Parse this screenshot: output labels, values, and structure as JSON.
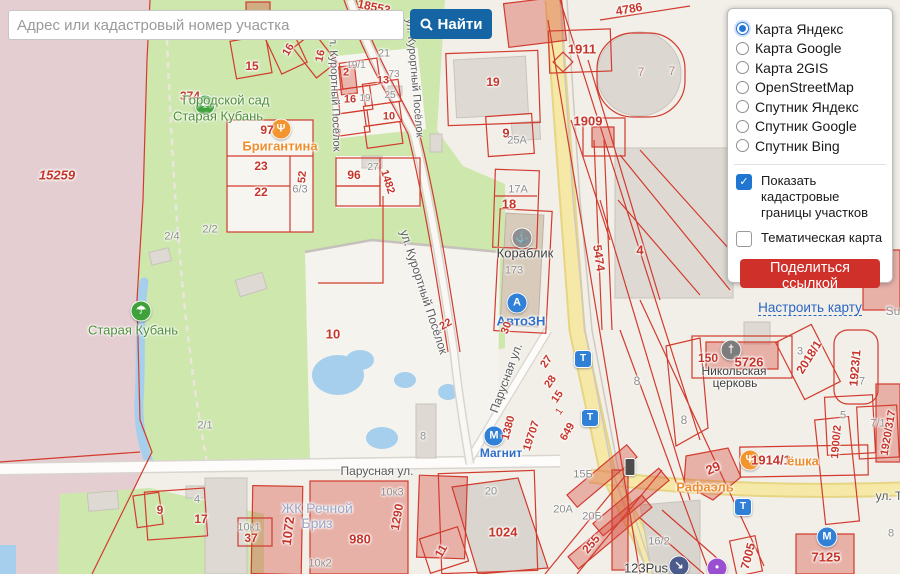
{
  "search": {
    "placeholder": "Адрес или кадастровый номер участка",
    "button_label": "Найти"
  },
  "panel": {
    "basemaps": [
      {
        "label": "Карта Яндекс",
        "selected": true
      },
      {
        "label": "Карта Google",
        "selected": false
      },
      {
        "label": "Карта 2GIS",
        "selected": false
      },
      {
        "label": "OpenStreetMap",
        "selected": false
      },
      {
        "label": "Спутник Яндекс",
        "selected": false
      },
      {
        "label": "Спутник Google",
        "selected": false
      },
      {
        "label": "Спутник Bing",
        "selected": false
      }
    ],
    "options": [
      {
        "label": "Показать кадастровые границы участков",
        "checked": true
      },
      {
        "label": "Тематическая карта",
        "checked": false
      }
    ],
    "share_button": "Поделиться ссылкой",
    "settings_link": "Настроить карту"
  },
  "map": {
    "palette": {
      "red": "#c6352a",
      "gray": "#8e8e8e",
      "dark": "#3f3f3f",
      "green": "#4f8f3a",
      "orange": "#ef8e2e",
      "blue": "#2f6fc8",
      "zk": "#98a6c6",
      "street": "#5a5a5a",
      "brick": "#b5867b"
    },
    "labels": [
      {
        "t": "18553",
        "x": 374,
        "y": 7,
        "c": "red",
        "s": 12,
        "r": 12,
        "b": 1
      },
      {
        "t": "16",
        "x": 289,
        "y": 50,
        "c": "red",
        "s": 11,
        "r": -60,
        "b": 1
      },
      {
        "t": "16",
        "x": 321,
        "y": 56,
        "c": "red",
        "s": 11,
        "r": -78,
        "b": 1
      },
      {
        "t": "15",
        "x": 252,
        "y": 66,
        "c": "red",
        "s": 12,
        "b": 1
      },
      {
        "t": "21",
        "x": 384,
        "y": 54,
        "c": "gray",
        "s": 11
      },
      {
        "t": "19/1",
        "x": 356,
        "y": 66,
        "c": "gray",
        "s": 10
      },
      {
        "t": "2",
        "x": 346,
        "y": 73,
        "c": "red",
        "s": 11,
        "b": 1
      },
      {
        "t": "13",
        "x": 383,
        "y": 81,
        "c": "red",
        "s": 11,
        "b": 1
      },
      {
        "t": "73",
        "x": 394,
        "y": 75,
        "c": "gray",
        "s": 10
      },
      {
        "t": "16",
        "x": 350,
        "y": 100,
        "c": "red",
        "s": 11,
        "b": 1
      },
      {
        "t": "19",
        "x": 365,
        "y": 99,
        "c": "gray",
        "s": 10
      },
      {
        "t": "25",
        "x": 390,
        "y": 96,
        "c": "gray",
        "s": 10
      },
      {
        "t": "10",
        "x": 389,
        "y": 117,
        "c": "red",
        "s": 11,
        "b": 1
      },
      {
        "t": "19",
        "x": 493,
        "y": 82,
        "c": "red",
        "s": 12,
        "b": 1
      },
      {
        "t": "374",
        "x": 190,
        "y": 96,
        "c": "red",
        "s": 12,
        "b": 1
      },
      {
        "t": "Городской сад",
        "x": 226,
        "y": 100,
        "c": "green",
        "s": 13
      },
      {
        "t": "Старая Кубань",
        "x": 218,
        "y": 116,
        "c": "green",
        "s": 13
      },
      {
        "t": "97",
        "x": 267,
        "y": 130,
        "c": "red",
        "s": 12,
        "b": 1
      },
      {
        "t": "Бригантина",
        "x": 280,
        "y": 146,
        "c": "orange",
        "s": 13,
        "b": 1
      },
      {
        "t": "23",
        "x": 261,
        "y": 166,
        "c": "red",
        "s": 12,
        "b": 1
      },
      {
        "t": "22",
        "x": 261,
        "y": 192,
        "c": "red",
        "s": 12,
        "b": 1
      },
      {
        "t": "52",
        "x": 303,
        "y": 177,
        "c": "red",
        "s": 11,
        "r": -85,
        "b": 1
      },
      {
        "t": "6/3",
        "x": 300,
        "y": 190,
        "c": "gray",
        "s": 11
      },
      {
        "t": "96",
        "x": 354,
        "y": 175,
        "c": "red",
        "s": 12,
        "b": 1
      },
      {
        "t": "27",
        "x": 373,
        "y": 168,
        "c": "gray",
        "s": 10
      },
      {
        "t": "1482",
        "x": 387,
        "y": 182,
        "c": "red",
        "s": 11,
        "r": 72,
        "b": 1
      },
      {
        "t": "15259",
        "x": 57,
        "y": 175,
        "c": "red",
        "s": 13,
        "i": 1,
        "b": 1
      },
      {
        "t": "2/4",
        "x": 172,
        "y": 237,
        "c": "gray",
        "s": 11
      },
      {
        "t": "2/2",
        "x": 210,
        "y": 230,
        "c": "gray",
        "s": 11
      },
      {
        "t": "10",
        "x": 333,
        "y": 334,
        "c": "red",
        "s": 13,
        "b": 1
      },
      {
        "t": "22",
        "x": 446,
        "y": 325,
        "c": "red",
        "s": 11,
        "r": -30,
        "b": 1
      },
      {
        "t": "2/1",
        "x": 205,
        "y": 426,
        "c": "gray",
        "s": 11
      },
      {
        "t": "Старая Кубань",
        "x": 133,
        "y": 330,
        "c": "green",
        "s": 13
      },
      {
        "t": "ул. Курортный Посёлок",
        "x": 414,
        "y": 78,
        "c": "street",
        "s": 11,
        "r": 85
      },
      {
        "t": "ул. Курортный Посёлок",
        "x": 334,
        "y": 92,
        "c": "street",
        "s": 11,
        "r": 88
      },
      {
        "t": "ул. Курортный Посёлок",
        "x": 424,
        "y": 292,
        "c": "street",
        "s": 12,
        "r": 72
      },
      {
        "t": "Парусная ул.",
        "x": 377,
        "y": 471,
        "c": "street",
        "s": 12
      },
      {
        "t": "Парусная ул.",
        "x": 506,
        "y": 378,
        "c": "street",
        "s": 12,
        "r": -70
      },
      {
        "t": "ул. Т",
        "x": 889,
        "y": 496,
        "c": "street",
        "s": 12
      },
      {
        "t": "9",
        "x": 506,
        "y": 133,
        "c": "red",
        "s": 13,
        "b": 1
      },
      {
        "t": "25А",
        "x": 517,
        "y": 141,
        "c": "gray",
        "s": 11
      },
      {
        "t": "1909",
        "x": 588,
        "y": 121,
        "c": "red",
        "s": 13,
        "b": 1
      },
      {
        "t": "1911",
        "x": 582,
        "y": 49,
        "c": "red",
        "s": 13,
        "b": 1
      },
      {
        "t": "4786",
        "x": 629,
        "y": 9,
        "c": "red",
        "s": 12,
        "r": -10,
        "b": 1
      },
      {
        "t": "7",
        "x": 641,
        "y": 72,
        "c": "brick",
        "s": 12
      },
      {
        "t": "7",
        "x": 672,
        "y": 71,
        "c": "brick",
        "s": 12
      },
      {
        "t": "17А",
        "x": 518,
        "y": 190,
        "c": "gray",
        "s": 11
      },
      {
        "t": "18",
        "x": 509,
        "y": 204,
        "c": "red",
        "s": 13,
        "b": 1
      },
      {
        "t": "Кораблик",
        "x": 525,
        "y": 253,
        "c": "dark",
        "s": 13
      },
      {
        "t": "173",
        "x": 514,
        "y": 271,
        "c": "gray",
        "s": 11
      },
      {
        "t": "АвтоЗН",
        "x": 521,
        "y": 321,
        "c": "blue",
        "s": 13,
        "b": 1
      },
      {
        "t": "30",
        "x": 507,
        "y": 328,
        "c": "red",
        "s": 11,
        "r": -70,
        "b": 1
      },
      {
        "t": "5474",
        "x": 599,
        "y": 258,
        "c": "red",
        "s": 12,
        "r": 82,
        "b": 1
      },
      {
        "t": "4",
        "x": 640,
        "y": 250,
        "c": "red",
        "s": 13,
        "b": 1
      },
      {
        "t": "27",
        "x": 547,
        "y": 362,
        "c": "red",
        "s": 11,
        "r": -55,
        "b": 1
      },
      {
        "t": "28",
        "x": 551,
        "y": 382,
        "c": "red",
        "s": 11,
        "r": -55,
        "b": 1
      },
      {
        "t": "15",
        "x": 558,
        "y": 397,
        "c": "red",
        "s": 11,
        "r": -55,
        "b": 1
      },
      {
        "t": "1",
        "x": 560,
        "y": 412,
        "c": "red",
        "s": 10,
        "r": -55
      },
      {
        "t": "1380",
        "x": 509,
        "y": 428,
        "c": "red",
        "s": 11,
        "r": -75,
        "b": 1
      },
      {
        "t": "19707",
        "x": 532,
        "y": 436,
        "c": "red",
        "s": 11,
        "r": -72,
        "b": 1
      },
      {
        "t": "649",
        "x": 568,
        "y": 432,
        "c": "red",
        "s": 11,
        "r": -60,
        "b": 1
      },
      {
        "t": "Магнит",
        "x": 501,
        "y": 453,
        "c": "blue",
        "s": 12,
        "b": 1
      },
      {
        "t": "15Б",
        "x": 583,
        "y": 475,
        "c": "gray",
        "s": 11
      },
      {
        "t": "8",
        "x": 637,
        "y": 381,
        "c": "gray",
        "s": 12
      },
      {
        "t": "8",
        "x": 423,
        "y": 437,
        "c": "gray",
        "s": 11
      },
      {
        "t": "ЖК Речной",
        "x": 317,
        "y": 508,
        "c": "zk",
        "s": 14
      },
      {
        "t": "Бриз",
        "x": 317,
        "y": 523,
        "c": "zk",
        "s": 14
      },
      {
        "t": "10к1",
        "x": 249,
        "y": 528,
        "c": "gray",
        "s": 11
      },
      {
        "t": "37",
        "x": 251,
        "y": 538,
        "c": "red",
        "s": 12,
        "b": 1
      },
      {
        "t": "1072",
        "x": 288,
        "y": 531,
        "c": "red",
        "s": 13,
        "r": -83,
        "b": 1
      },
      {
        "t": "980",
        "x": 360,
        "y": 539,
        "c": "red",
        "s": 13,
        "b": 1
      },
      {
        "t": "1290",
        "x": 397,
        "y": 517,
        "c": "red",
        "s": 12,
        "r": -80,
        "b": 1
      },
      {
        "t": "10к3",
        "x": 392,
        "y": 493,
        "c": "gray",
        "s": 11
      },
      {
        "t": "10к2",
        "x": 320,
        "y": 564,
        "c": "gray",
        "s": 11
      },
      {
        "t": "11",
        "x": 441,
        "y": 551,
        "c": "red",
        "s": 12,
        "r": -60,
        "b": 1
      },
      {
        "t": "9",
        "x": 160,
        "y": 510,
        "c": "red",
        "s": 12,
        "b": 1
      },
      {
        "t": "4",
        "x": 197,
        "y": 500,
        "c": "gray",
        "s": 11
      },
      {
        "t": "17",
        "x": 201,
        "y": 519,
        "c": "red",
        "s": 12,
        "b": 1
      },
      {
        "t": "20",
        "x": 491,
        "y": 492,
        "c": "gray",
        "s": 11
      },
      {
        "t": "1024",
        "x": 503,
        "y": 532,
        "c": "red",
        "s": 13,
        "b": 1
      },
      {
        "t": "20А",
        "x": 563,
        "y": 510,
        "c": "gray",
        "s": 11
      },
      {
        "t": "20Б",
        "x": 592,
        "y": 517,
        "c": "gray",
        "s": 11
      },
      {
        "t": "255",
        "x": 591,
        "y": 544,
        "c": "red",
        "s": 12,
        "r": -50,
        "b": 1
      },
      {
        "t": "16/2",
        "x": 659,
        "y": 542,
        "c": "gray",
        "s": 11
      },
      {
        "t": "123Pus",
        "x": 646,
        "y": 568,
        "c": "dark",
        "s": 13
      },
      {
        "t": "150",
        "x": 708,
        "y": 358,
        "c": "red",
        "s": 12,
        "b": 1
      },
      {
        "t": "5726",
        "x": 749,
        "y": 362,
        "c": "red",
        "s": 13,
        "b": 1
      },
      {
        "t": "Никольская",
        "x": 734,
        "y": 371,
        "c": "dark",
        "s": 12
      },
      {
        "t": "церковь",
        "x": 735,
        "y": 383,
        "c": "dark",
        "s": 12
      },
      {
        "t": "2018/1",
        "x": 809,
        "y": 357,
        "c": "red",
        "s": 12,
        "r": -58,
        "b": 1
      },
      {
        "t": "1923/1",
        "x": 855,
        "y": 368,
        "c": "red",
        "s": 12,
        "r": -85,
        "b": 1
      },
      {
        "t": "3",
        "x": 800,
        "y": 352,
        "c": "gray",
        "s": 11
      },
      {
        "t": "7",
        "x": 862,
        "y": 382,
        "c": "gray",
        "s": 11
      },
      {
        "t": "8",
        "x": 684,
        "y": 420,
        "c": "gray",
        "s": 12
      },
      {
        "t": "5",
        "x": 843,
        "y": 416,
        "c": "gray",
        "s": 11
      },
      {
        "t": "7/1",
        "x": 878,
        "y": 424,
        "c": "gray",
        "s": 11
      },
      {
        "t": "1900/2",
        "x": 837,
        "y": 442,
        "c": "red",
        "s": 11,
        "r": -85,
        "b": 1
      },
      {
        "t": "1920/317",
        "x": 889,
        "y": 433,
        "c": "red",
        "s": 11,
        "r": -80,
        "b": 1
      },
      {
        "t": "29",
        "x": 713,
        "y": 468,
        "c": "red",
        "s": 13,
        "r": -25,
        "b": 1
      },
      {
        "t": "Рафаэль",
        "x": 705,
        "y": 487,
        "c": "orange",
        "s": 13,
        "b": 1
      },
      {
        "t": "1914/1",
        "x": 771,
        "y": 460,
        "c": "red",
        "s": 13,
        "b": 1
      },
      {
        "t": "ёшка",
        "x": 803,
        "y": 461,
        "c": "orange",
        "s": 13,
        "b": 1
      },
      {
        "t": "7005",
        "x": 748,
        "y": 556,
        "c": "red",
        "s": 12,
        "r": -75,
        "b": 1
      },
      {
        "t": "7125",
        "x": 826,
        "y": 557,
        "c": "red",
        "s": 13,
        "b": 1
      },
      {
        "t": "8",
        "x": 891,
        "y": 534,
        "c": "gray",
        "s": 11
      },
      {
        "t": "Su",
        "x": 893,
        "y": 311,
        "c": "gray",
        "s": 12
      }
    ],
    "icons": [
      {
        "n": "park-tree-icon",
        "x": 205,
        "y": 105,
        "sh": "c",
        "bg": "#3fa13a",
        "g": "♣"
      },
      {
        "n": "beach-icon",
        "x": 141,
        "y": 311,
        "sh": "c",
        "bg": "#3fa13a",
        "g": "☂"
      },
      {
        "n": "restaurant-icon",
        "x": 281,
        "y": 129,
        "sh": "c",
        "bg": "#f2952f",
        "g": "Ψ"
      },
      {
        "n": "shop-korablik-icon",
        "x": 522,
        "y": 238,
        "sh": "c",
        "bg": "#8f8f8f",
        "g": "⚓"
      },
      {
        "n": "car-service-icon",
        "x": 517,
        "y": 303,
        "sh": "c",
        "bg": "#2f80d6",
        "g": "А"
      },
      {
        "n": "store-magnit-icon",
        "x": 494,
        "y": 436,
        "sh": "c",
        "bg": "#2f80d6",
        "g": "М"
      },
      {
        "n": "church-icon",
        "x": 731,
        "y": 350,
        "sh": "c",
        "bg": "#7c7c7c",
        "g": "†"
      },
      {
        "n": "cafe-icon",
        "x": 750,
        "y": 460,
        "sh": "c",
        "bg": "#f2952f",
        "g": "Ψ"
      },
      {
        "n": "store-magnit-icon",
        "x": 827,
        "y": 537,
        "sh": "c",
        "bg": "#2f80d6",
        "g": "М"
      },
      {
        "n": "tram-stop-icon",
        "x": 583,
        "y": 359,
        "sh": "s",
        "bg": "#2f80d6",
        "g": "Т"
      },
      {
        "n": "tram-stop-icon",
        "x": 590,
        "y": 418,
        "sh": "s",
        "bg": "#2f80d6",
        "g": "Т"
      },
      {
        "n": "tram-stop-icon",
        "x": 743,
        "y": 507,
        "sh": "s",
        "bg": "#2f80d6",
        "g": "Т"
      },
      {
        "n": "underpass-icon",
        "x": 679,
        "y": 566,
        "sh": "c",
        "bg": "#4a5b8c",
        "g": "↘"
      },
      {
        "n": "poi-icon",
        "x": 717,
        "y": 568,
        "sh": "c",
        "bg": "#9a4fd0",
        "g": "•"
      },
      {
        "n": "traffic-light-icon",
        "x": 630,
        "y": 467,
        "sh": "t",
        "bg": "#4c4c4c",
        "g": ""
      }
    ]
  }
}
